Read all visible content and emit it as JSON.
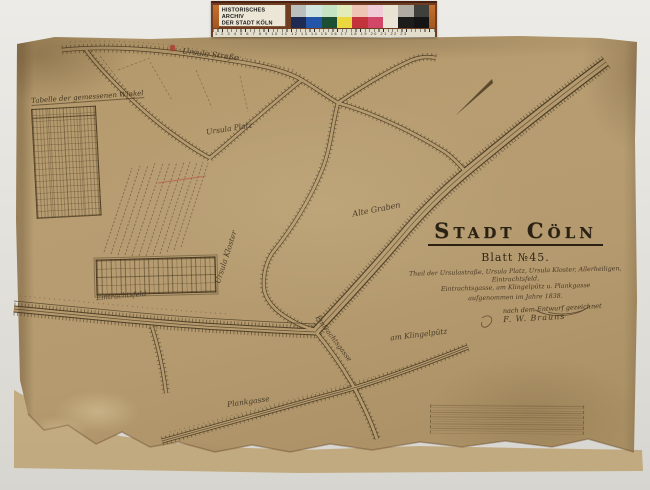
{
  "archive_bar": {
    "title_line1": "HISTORISCHES ARCHIV",
    "title_line2": "DER STADT KÖLN",
    "ruler_numbers": "1 2 3 4 5 6 7 8 9 10 11 12 13 14 15 16 17 18 19 20 21 22 23",
    "frame_color": "#6e3d22",
    "patches_top": [
      "#bcc0bc",
      "#d2e5e0",
      "#c6e4c4",
      "#e2ecba",
      "#eec4b4",
      "#efccd7",
      "#e9e3d3",
      "#b0aca4",
      "#3f3f3c"
    ],
    "patches_bottom": [
      "#1d2b52",
      "#2356a8",
      "#1d4f33",
      "#ead83e",
      "#c2333c",
      "#d24768",
      "#eae5d6",
      "#1c1c1a",
      "#141414"
    ]
  },
  "map": {
    "title": "Stadt Cöln",
    "sheet_label": "Blatt №45.",
    "description_line1": "Theil der Ursulastraße, Ursula Platz, Ursula Kloster, Allerheiligen, Eintrachtsfeld,",
    "description_line2": "Eintrachtsgasse, am Klingelpütz u. Plankgasse",
    "date_line": "aufgenommen im Jahre 1838.",
    "signature_line1": "nach dem Entwurf gezeichnet",
    "signature_line2": "F. W. Brauns",
    "angle_table_title": "Tabelle der gemessenen Winkel",
    "street_labels": {
      "ursula_strasse": "Ursula Straße",
      "ursula_platz": "Ursula Platz",
      "ursula_kloster": "Ursula Kloster",
      "alte_graben": "Alte Graben",
      "eintrachtsgasse": "Eintrachtsgasse",
      "am_klingelpuetz": "am Klingelpütz",
      "plankgasse": "Plankgasse",
      "eintrachtsfeld": "Eintrachtsfeld"
    },
    "paper_color": "#b49a6e",
    "ink_color": "#43341f",
    "accent_red": "#a83b32"
  }
}
